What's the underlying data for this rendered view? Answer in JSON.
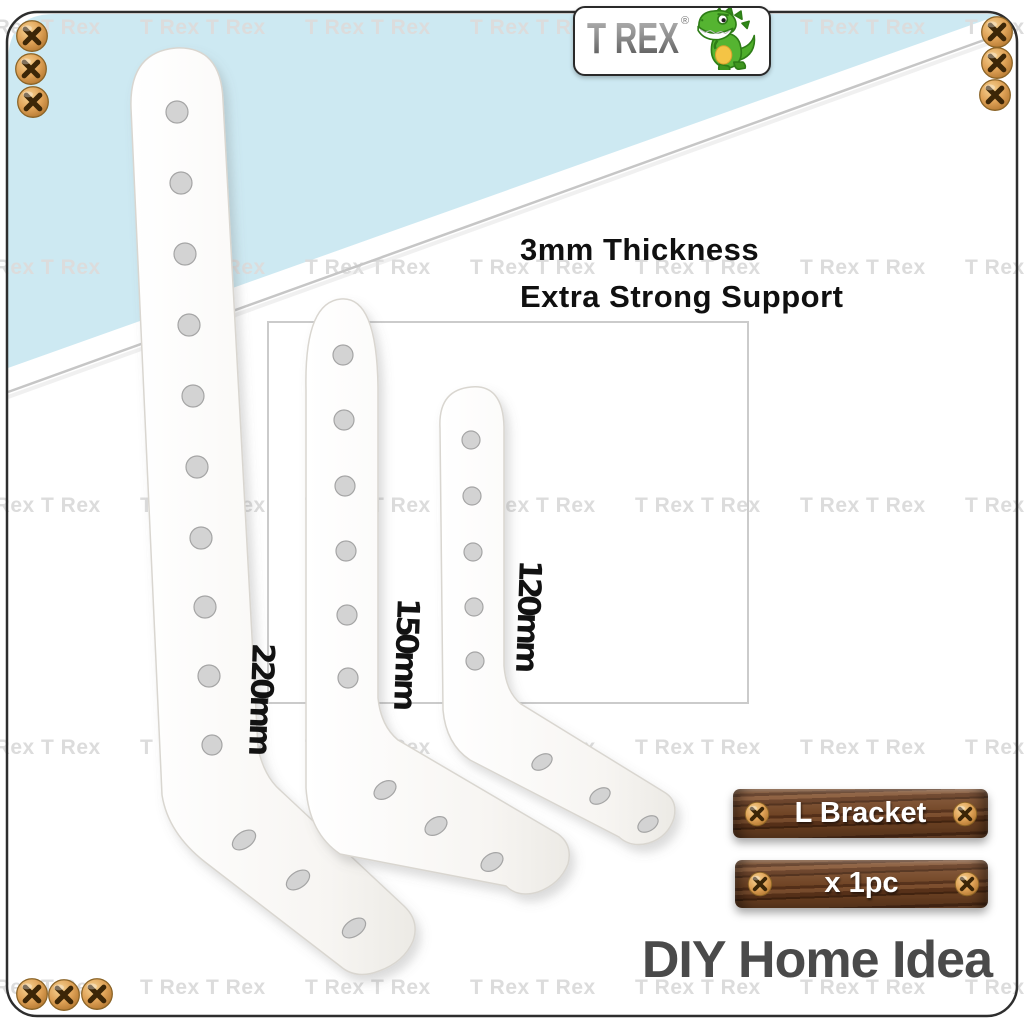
{
  "image_type": "e-commerce product photo collage",
  "brand": {
    "logo_text": "T REX",
    "registered_mark": "®",
    "logo_icon": "cartoon-green-trex",
    "brand_green": "#55b431"
  },
  "watermark": {
    "text": "T Rex T Rex",
    "color": "#dcdcdc",
    "row_centers_y": [
      30,
      270,
      508,
      750,
      990
    ],
    "column_xs": [
      -25,
      140,
      305,
      470,
      635,
      800,
      965
    ]
  },
  "headline": {
    "line1": "3mm Thickness",
    "line2": "Extra Strong Support",
    "color": "#101010"
  },
  "brackets": [
    {
      "name": "L bracket 220mm",
      "size_label": "220mm",
      "vertical_holes": 10,
      "horizontal_holes": 3
    },
    {
      "name": "L bracket 150mm",
      "size_label": "150mm",
      "vertical_holes": 6,
      "horizontal_holes": 3
    },
    {
      "name": "L bracket 120mm",
      "size_label": "120mm",
      "vertical_holes": 5,
      "horizontal_holes": 3
    }
  ],
  "plates": {
    "product_name": "L Bracket",
    "quantity": "x 1pc",
    "wood_color": "#6e4124",
    "text_color": "#ffffff"
  },
  "footer": {
    "text": "DIY Home Idea",
    "color": "#4a4a4a"
  },
  "background": {
    "accent_blue": "#cde9f2",
    "frame_border": "#2e2e2e",
    "inner_box_border": "#cbcbcb",
    "diagonal_line": "#c6c6c6",
    "screw_gold": "#d99c4e"
  }
}
